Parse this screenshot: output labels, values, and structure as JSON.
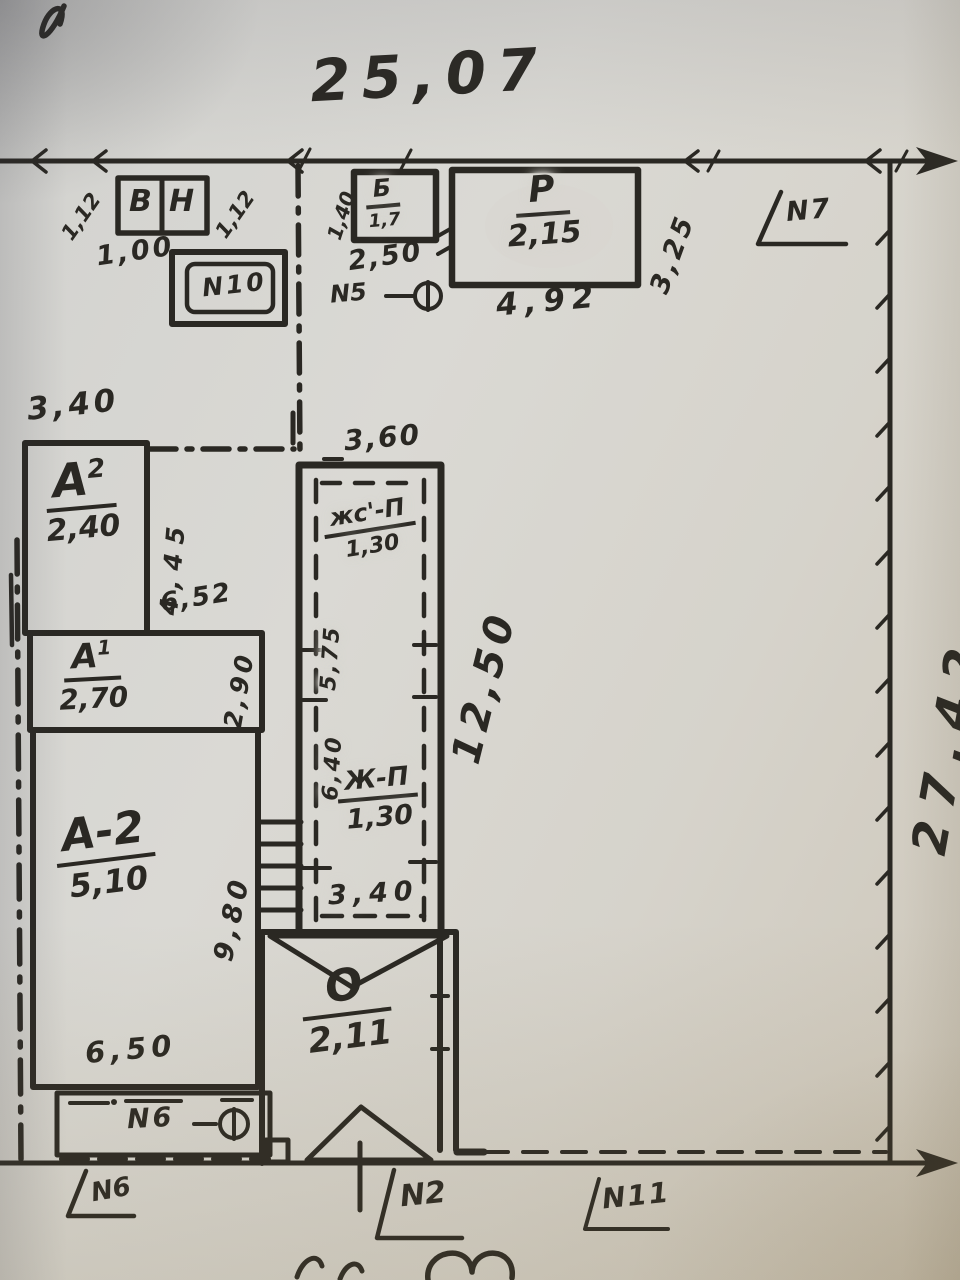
{
  "colors": {
    "paper": "#d8d6d0",
    "ink": "#2a2823"
  },
  "boundary": {
    "top_dimension": "25,07",
    "right_dimension": "27,42"
  },
  "marks": {
    "n2": "N2",
    "n5": "N5",
    "n6": "N6",
    "n6_strip": "N6",
    "n7": "N7",
    "n10": "N10",
    "n11": "N11"
  },
  "dims": {
    "d112_left": "1,12",
    "d112_right": "1,12",
    "d100": "1,00",
    "d140": "1,40",
    "d250": "2,50",
    "d492": "4,92",
    "d325": "3,25",
    "d340": "3,40",
    "d445": "4,45",
    "d652": "6,52",
    "d290": "2,90",
    "d980": "9,80",
    "d650": "6,50",
    "d360": "3,60",
    "d575": "5,75",
    "d640": "6,40",
    "d340_b": "3,40",
    "d1250": "12,50"
  },
  "buildings": {
    "vn": {
      "cell1": "В",
      "cell2": "Н"
    },
    "b": {
      "name": "Б",
      "area": "1,7"
    },
    "p": {
      "name": "Р",
      "area": "2,15"
    },
    "a2_upper": {
      "name": "А",
      "sup": "2",
      "area": "2,40"
    },
    "a1": {
      "name": "А",
      "sup": "1",
      "area": "2,70"
    },
    "a2": {
      "name": "А-2",
      "area": "5,10"
    },
    "zhs": {
      "name": "жс'-П",
      "area": "1,30"
    },
    "zh": {
      "name": "Ж-П",
      "area": "1,30"
    },
    "o": {
      "name": "О",
      "area": "2,11"
    }
  }
}
